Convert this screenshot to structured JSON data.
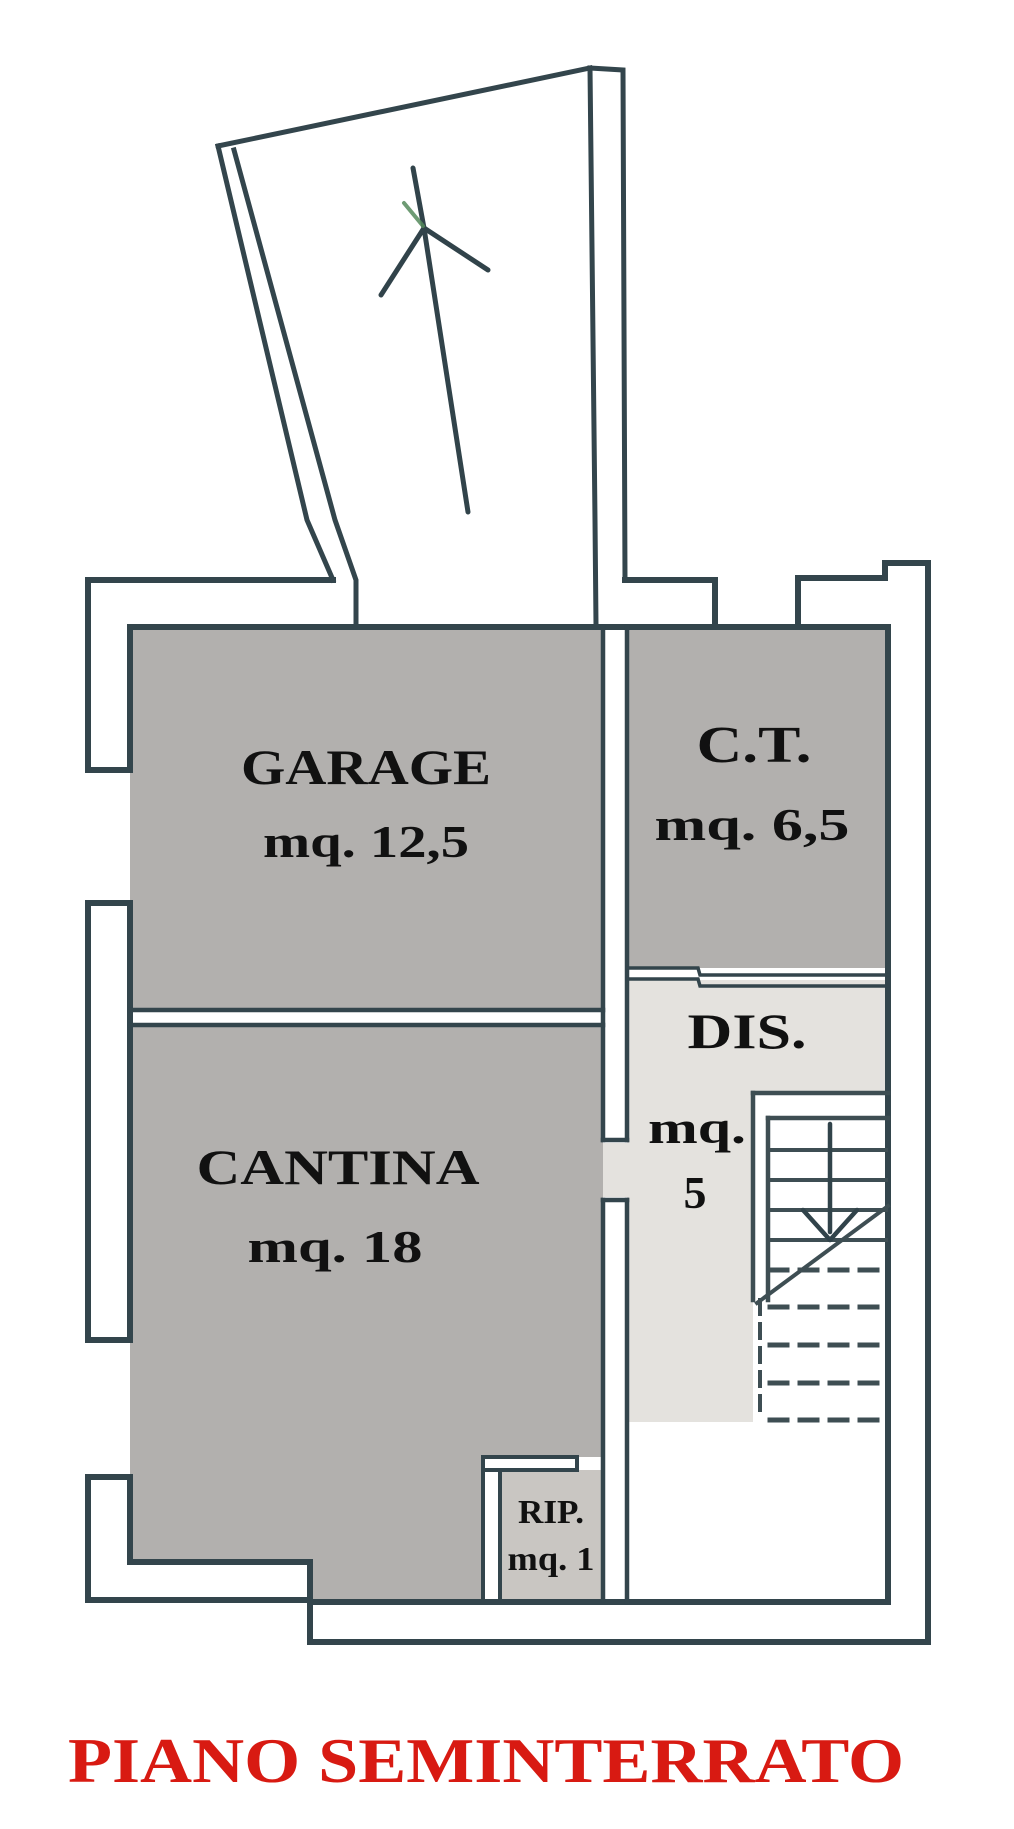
{
  "document": {
    "type": "floor-plan",
    "language": "italian"
  },
  "title": {
    "text": "PIANO SEMINTERRATO",
    "color": "#d81a12"
  },
  "rooms": [
    {
      "id": "garage",
      "label": "GARAGE",
      "area": "mq. 12,5",
      "fill": "#b2b0ae"
    },
    {
      "id": "ct",
      "label": "C.T.",
      "area": "mq. 6,5",
      "fill": "#b2b0ae"
    },
    {
      "id": "dis",
      "label": "DIS.",
      "area_unit": "mq.",
      "area_value": "5",
      "fill": "#e4e2de"
    },
    {
      "id": "cantina",
      "label": "CANTINA",
      "area": "mq. 18",
      "fill": "#b2b0ae"
    },
    {
      "id": "rip",
      "label": "RIP.",
      "area": "mq. 1",
      "fill": "#c9c6c2"
    }
  ],
  "colors": {
    "paper": "#ffffff",
    "wall": "#33454c",
    "stair_detail": "#3e4e53",
    "arrow_tint_green": "#55895c"
  },
  "symbols": {
    "ramp_arrow": "up-arrow",
    "stairs_arrow": "down-arrow"
  }
}
